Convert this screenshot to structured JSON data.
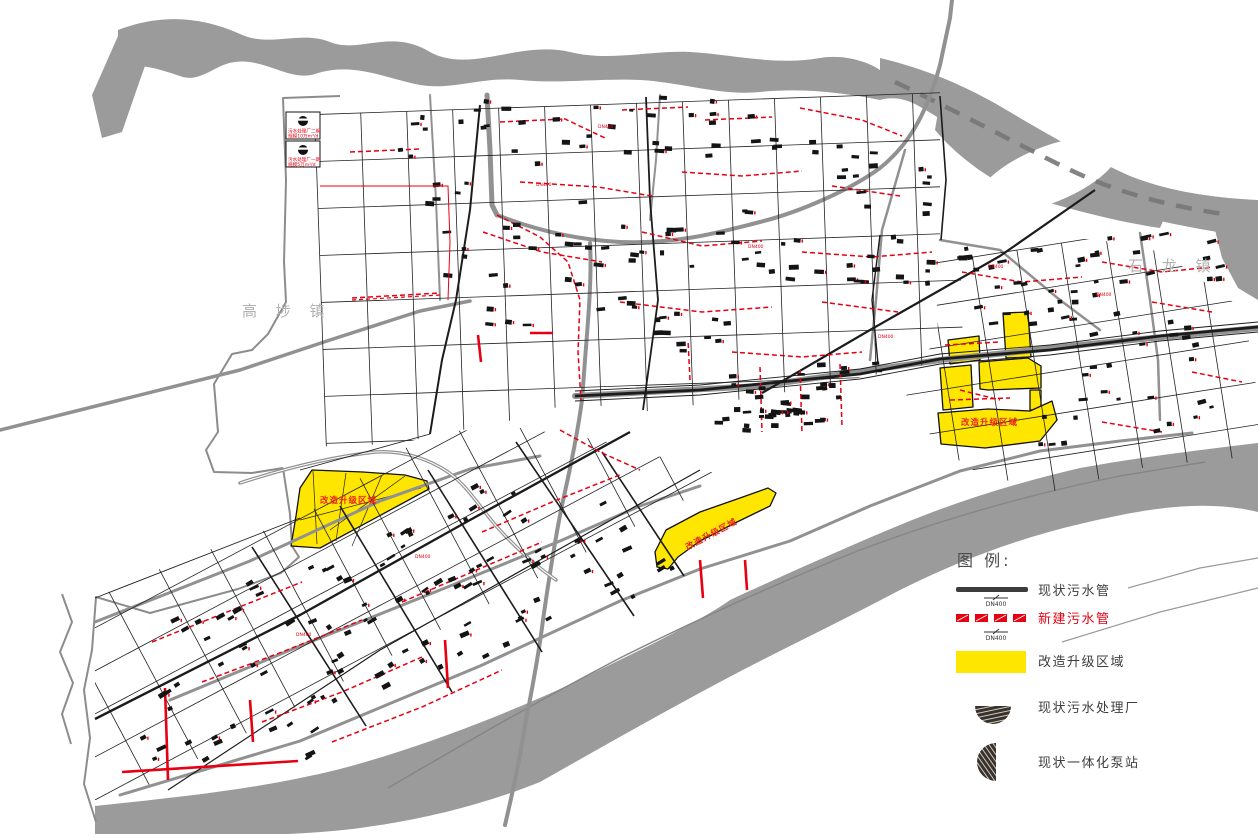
{
  "map": {
    "towns": [
      {
        "name": "高 埗 镇"
      },
      {
        "name": "石 龙 镇"
      }
    ],
    "upgrade_zone_label": "改造升级区域",
    "plant_callouts": [
      {
        "title": "污水处理厂二期",
        "scale": "规模10万m³/d"
      },
      {
        "title": "污水处理厂一期",
        "scale": "规模5万m³/d"
      }
    ],
    "pipe_size_label": "DN400",
    "colors": {
      "river": "#9b9b9b",
      "upgrade_zone": "#ffe600",
      "new_pipe": "#e60012",
      "existing_pipe": "#1c1c1c",
      "road_gray": "#919191"
    }
  },
  "legend": {
    "title": "图 例:",
    "items": [
      {
        "type": "existing-pipe",
        "label": "现状污水管",
        "sub": "DN400"
      },
      {
        "type": "new-pipe",
        "label": "新建污水管",
        "sub": "DN400"
      },
      {
        "type": "upgrade-zone",
        "label": "改造升级区域"
      },
      {
        "type": "plant",
        "label": "现状污水处理厂"
      },
      {
        "type": "pump",
        "label": "现状一体化泵站"
      }
    ]
  }
}
